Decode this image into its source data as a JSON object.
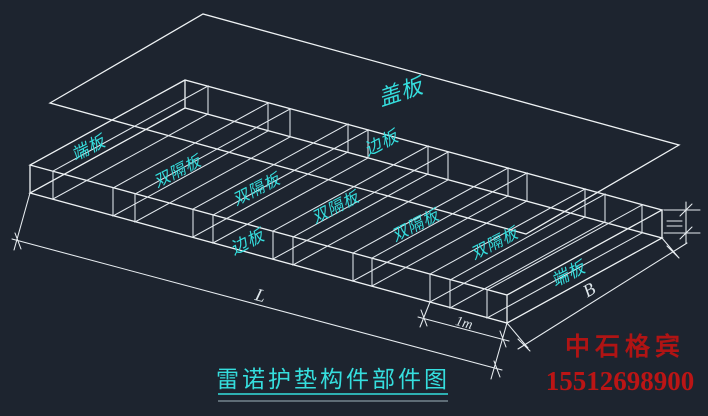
{
  "drawing": {
    "type": "cad-wireframe-isometric",
    "subject": "gabion-reno-mattress-components",
    "colors": {
      "background": "#1d242f",
      "wireframe": "#eef2f4",
      "labels": "#35dede",
      "branding_red": "#b01414"
    },
    "labels": {
      "cover_plate": "盖板",
      "end_plate_left": "端板",
      "end_plate_right": "端板",
      "side_plate_back": "边板",
      "side_plate_front": "边板",
      "diaphragms": [
        "双隔板",
        "双隔板",
        "双隔板",
        "双隔板",
        "双隔板"
      ]
    },
    "dimensions": {
      "length": "L",
      "width": "B",
      "cell_width": "1m"
    },
    "title": {
      "text": "雷诺护垫构件部件图"
    },
    "branding": {
      "company": "中石格宾",
      "phone": "15512698900"
    }
  }
}
